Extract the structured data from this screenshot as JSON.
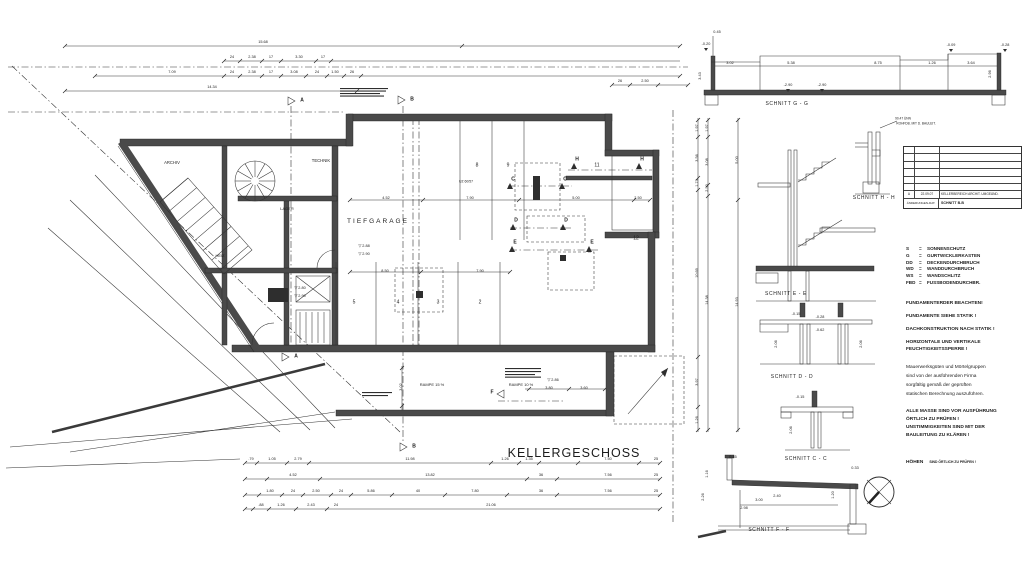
{
  "title": "KELLERGESCHOSS",
  "colors": {
    "ink": "#2a2a2a",
    "paper": "#ffffff"
  },
  "plan": {
    "text_labels": [
      {
        "t": "TIEFGARAGE",
        "x": 378,
        "y": 222,
        "s": 6.5,
        "ls": 2
      },
      {
        "t": "ARCHIV",
        "x": 172,
        "y": 163,
        "s": 4.2
      },
      {
        "t": "TECHNIK",
        "x": 321,
        "y": 161,
        "s": 4.2
      },
      {
        "t": "LAGER",
        "x": 287,
        "y": 209,
        "s": 4
      },
      {
        "t": "HEIZ",
        "x": 220,
        "y": 256,
        "s": 4
      },
      {
        "t": "8",
        "x": 477,
        "y": 166,
        "s": 5
      },
      {
        "t": "9",
        "x": 508,
        "y": 166,
        "s": 5
      },
      {
        "t": "11",
        "x": 597,
        "y": 166,
        "s": 5
      },
      {
        "t": "12",
        "x": 636,
        "y": 239,
        "s": 5
      },
      {
        "t": "5",
        "x": 354,
        "y": 303,
        "s": 5
      },
      {
        "t": "4",
        "x": 398,
        "y": 303,
        "s": 5
      },
      {
        "t": "3",
        "x": 438,
        "y": 303,
        "s": 5
      },
      {
        "t": "2",
        "x": 480,
        "y": 303,
        "s": 5
      },
      {
        "t": "RAMPE 15 %",
        "x": 432,
        "y": 385,
        "s": 4
      },
      {
        "t": "RAMPE 10 %",
        "x": 521,
        "y": 385,
        "s": 4
      },
      {
        "t": "▽ 2.88",
        "x": 364,
        "y": 247,
        "s": 3.8
      },
      {
        "t": "▽ 2.90",
        "x": 364,
        "y": 255,
        "s": 3.8
      },
      {
        "t": "▽ 2.80",
        "x": 300,
        "y": 289,
        "s": 3.8
      },
      {
        "t": "▽ 2.90",
        "x": 300,
        "y": 297,
        "s": 3.8
      },
      {
        "t": "▽ 2.86",
        "x": 553,
        "y": 381,
        "s": 3.8
      },
      {
        "t": "UZ 60/57",
        "x": 466,
        "y": 182,
        "s": 3.4
      }
    ],
    "section_markers": [
      {
        "t": "A",
        "x": 302,
        "y": 101
      },
      {
        "t": "B",
        "x": 412,
        "y": 100
      },
      {
        "t": "A",
        "x": 296,
        "y": 357
      },
      {
        "t": "B",
        "x": 414,
        "y": 447
      },
      {
        "t": "F",
        "x": 492,
        "y": 393
      },
      {
        "t": "H",
        "x": 577,
        "y": 160
      },
      {
        "t": "H",
        "x": 642,
        "y": 160
      },
      {
        "t": "C",
        "x": 513,
        "y": 180
      },
      {
        "t": "C",
        "x": 565,
        "y": 180
      },
      {
        "t": "D",
        "x": 516,
        "y": 221
      },
      {
        "t": "D",
        "x": 566,
        "y": 221
      },
      {
        "t": "E",
        "x": 515,
        "y": 243
      },
      {
        "t": "E",
        "x": 592,
        "y": 243
      }
    ],
    "dim_labels": [
      {
        "t": "15.68",
        "x": 263,
        "y": 43
      },
      {
        "t": "24",
        "x": 232,
        "y": 58
      },
      {
        "t": "2.38",
        "x": 252,
        "y": 58
      },
      {
        "t": "17",
        "x": 271,
        "y": 58
      },
      {
        "t": "3.30",
        "x": 299,
        "y": 58
      },
      {
        "t": "17",
        "x": 323,
        "y": 58
      },
      {
        "t": "7.09",
        "x": 172,
        "y": 73
      },
      {
        "t": "24",
        "x": 232,
        "y": 73
      },
      {
        "t": "2.38",
        "x": 252,
        "y": 73
      },
      {
        "t": "17",
        "x": 271,
        "y": 73
      },
      {
        "t": "3.08",
        "x": 294,
        "y": 73
      },
      {
        "t": "24",
        "x": 317,
        "y": 73
      },
      {
        "t": "1.50",
        "x": 335,
        "y": 73
      },
      {
        "t": "26",
        "x": 352,
        "y": 73
      },
      {
        "t": "14.34",
        "x": 212,
        "y": 88
      },
      {
        "t": "26",
        "x": 620,
        "y": 82
      },
      {
        "t": "2.50",
        "x": 645,
        "y": 82
      },
      {
        "t": ".79",
        "x": 251,
        "y": 460
      },
      {
        "t": "1.05",
        "x": 272,
        "y": 460
      },
      {
        "t": "2.79",
        "x": 298,
        "y": 460
      },
      {
        "t": "11.98",
        "x": 410,
        "y": 460
      },
      {
        "t": "1.26",
        "x": 505,
        "y": 460
      },
      {
        "t": "1.35",
        "x": 529,
        "y": 460
      },
      {
        "t": "7.50",
        "x": 608,
        "y": 460
      },
      {
        "t": "25",
        "x": 656,
        "y": 460
      },
      {
        "t": "4.52",
        "x": 293,
        "y": 476
      },
      {
        "t": "13.82",
        "x": 430,
        "y": 476
      },
      {
        "t": "36",
        "x": 541,
        "y": 476
      },
      {
        "t": "7.56",
        "x": 608,
        "y": 476
      },
      {
        "t": "25",
        "x": 656,
        "y": 476
      },
      {
        "t": "1.80",
        "x": 270,
        "y": 492
      },
      {
        "t": "24",
        "x": 293,
        "y": 492
      },
      {
        "t": "2.50",
        "x": 316,
        "y": 492
      },
      {
        "t": "24",
        "x": 341,
        "y": 492
      },
      {
        "t": "5.86",
        "x": 371,
        "y": 492
      },
      {
        "t": "40",
        "x": 418,
        "y": 492
      },
      {
        "t": "7.80",
        "x": 475,
        "y": 492
      },
      {
        "t": "36",
        "x": 541,
        "y": 492
      },
      {
        "t": "7.56",
        "x": 608,
        "y": 492
      },
      {
        "t": "25",
        "x": 656,
        "y": 492
      },
      {
        "t": ".88",
        "x": 261,
        "y": 506
      },
      {
        "t": "1.26",
        "x": 281,
        "y": 506
      },
      {
        "t": "2.43",
        "x": 311,
        "y": 506
      },
      {
        "t": "24",
        "x": 336,
        "y": 506
      },
      {
        "t": "21.06",
        "x": 491,
        "y": 506
      },
      {
        "t": "1.97",
        "x": 698,
        "y": 128,
        "r": 1
      },
      {
        "t": "3.56",
        "x": 698,
        "y": 158,
        "r": 1
      },
      {
        "t": "1.73",
        "x": 698,
        "y": 183,
        "r": 1
      },
      {
        "t": "10.69",
        "x": 698,
        "y": 273,
        "r": 1
      },
      {
        "t": "3.97",
        "x": 698,
        "y": 382,
        "r": 1
      },
      {
        "t": "1.26",
        "x": 698,
        "y": 420,
        "r": 1
      },
      {
        "t": "1.97",
        "x": 708,
        "y": 128,
        "r": 1
      },
      {
        "t": "3.08",
        "x": 708,
        "y": 162,
        "r": 1
      },
      {
        "t": "2.50",
        "x": 708,
        "y": 188,
        "r": 1
      },
      {
        "t": "14.38",
        "x": 708,
        "y": 300,
        "r": 1
      },
      {
        "t": "5.00",
        "x": 738,
        "y": 160,
        "r": 1
      },
      {
        "t": "14.93",
        "x": 738,
        "y": 302,
        "r": 1
      },
      {
        "t": "4.52",
        "x": 386,
        "y": 199
      },
      {
        "t": "7.90",
        "x": 470,
        "y": 199
      },
      {
        "t": "5.00",
        "x": 576,
        "y": 199
      },
      {
        "t": "2.50",
        "x": 638,
        "y": 199
      },
      {
        "t": "8.50",
        "x": 385,
        "y": 272
      },
      {
        "t": "7.90",
        "x": 480,
        "y": 272
      },
      {
        "t": "3.80",
        "x": 549,
        "y": 389
      },
      {
        "t": "3.60",
        "x": 584,
        "y": 389
      },
      {
        "t": "3.02",
        "x": 402,
        "y": 387,
        "r": 1
      },
      {
        "t": "0.45",
        "x": 717,
        "y": 33
      },
      {
        "t": "-0.20",
        "x": 706,
        "y": 45
      },
      {
        "t": "-0.09",
        "x": 951,
        "y": 46
      },
      {
        "t": "-0.28",
        "x": 1005,
        "y": 46
      },
      {
        "t": "3.02",
        "x": 730,
        "y": 64
      },
      {
        "t": "5.38",
        "x": 791,
        "y": 64
      },
      {
        "t": "8.75",
        "x": 878,
        "y": 64
      },
      {
        "t": "1.26",
        "x": 932,
        "y": 64
      },
      {
        "t": "3.64",
        "x": 971,
        "y": 64
      },
      {
        "t": "-2.90",
        "x": 788,
        "y": 86
      },
      {
        "t": "-2.90",
        "x": 822,
        "y": 86
      },
      {
        "t": "3.43",
        "x": 701,
        "y": 76,
        "r": 1
      },
      {
        "t": "2.96",
        "x": 991,
        "y": 74,
        "r": 1
      },
      {
        "t": "90.47 ÜNN",
        "x": 903,
        "y": 119,
        "s": 3.2
      },
      {
        "t": "ROHFDB. MIT D. BAULEIT.",
        "x": 916,
        "y": 124,
        "s": 3.2
      },
      {
        "t": "-0.15",
        "x": 796,
        "y": 315
      },
      {
        "t": "-0.28",
        "x": 820,
        "y": 318
      },
      {
        "t": "-0.62",
        "x": 820,
        "y": 331
      },
      {
        "t": "2.06",
        "x": 777,
        "y": 344,
        "r": 1
      },
      {
        "t": "2.06",
        "x": 862,
        "y": 344,
        "r": 1
      },
      {
        "t": "-0.15",
        "x": 800,
        "y": 398
      },
      {
        "t": "2.06",
        "x": 792,
        "y": 430,
        "r": 1
      },
      {
        "t": "0.45",
        "x": 733,
        "y": 458
      },
      {
        "t": "0.33",
        "x": 855,
        "y": 469
      },
      {
        "t": "2.40",
        "x": 777,
        "y": 497
      },
      {
        "t": "3.00",
        "x": 759,
        "y": 501
      },
      {
        "t": "1.20",
        "x": 834,
        "y": 495,
        "r": 1
      },
      {
        "t": "2.98",
        "x": 744,
        "y": 509
      },
      {
        "t": "2.26",
        "x": 704,
        "y": 497,
        "r": 1
      },
      {
        "t": "1.16",
        "x": 708,
        "y": 474,
        "r": 1
      }
    ]
  },
  "sections": {
    "g": {
      "label": "SCHNITT G - G"
    },
    "h": {
      "label": "SCHNITT H - H"
    },
    "e": {
      "label": "SCHNITT E - E"
    },
    "d": {
      "label": "SCHNITT D - D"
    },
    "c": {
      "label": "SCHNITT C - C"
    },
    "f": {
      "label": "SCHNITT F - F"
    }
  },
  "revision_table": {
    "rev": "A",
    "date": "22.09.07",
    "desc": "KELLERBEREICH ARCHIT. UMGEÄND.",
    "footer_left": "ÄNDERUNGEN-DAT.",
    "footer_right": "SCHNITT B-B"
  },
  "legend": {
    "items": [
      {
        "abbr": "S",
        "eq": "=",
        "name": "SONNENSCHUTZ"
      },
      {
        "abbr": "G",
        "eq": "=",
        "name": "GURTWICKLERKASTEN"
      },
      {
        "abbr": "DD",
        "eq": "=",
        "name": "DECKENDURCHBRUCH"
      },
      {
        "abbr": "WD",
        "eq": "=",
        "name": "WANDDURCHBRUCH"
      },
      {
        "abbr": "WS",
        "eq": "=",
        "name": "WANDSCHLITZ"
      },
      {
        "abbr": "FBD",
        "eq": "=",
        "name": "FUSSBODENDURCHBR."
      }
    ]
  },
  "notes_block1": [
    {
      "t": "FUNDAMENTERDER BEACHTEN!",
      "dy": 0
    },
    {
      "t": "FUNDAMENTE SIEHE STATIK !",
      "dy": 13
    },
    {
      "t": "DACHKONSTRUKTION NACH STATIK !",
      "dy": 13
    },
    {
      "t": "HORIZONTALE UND VERTIKALE",
      "dy": 13
    },
    {
      "t": "FEUCHTIGKEITSSPERRE !",
      "dy": 7
    }
  ],
  "paragraph": [
    {
      "t": "Mauerwerksgüten und Mörtelgruppen",
      "dy": 0
    },
    {
      "t": "sind von der ausführenden Firma",
      "dy": 9
    },
    {
      "t": "sorgfältig gemäß der geprüften",
      "dy": 9
    },
    {
      "t": "statischen Berechnung auszuführen.",
      "dy": 9
    }
  ],
  "notes_block2": [
    {
      "t": "ALLE MASSE SIND VOR AUSFÜHRUNG",
      "dy": 0
    },
    {
      "t": "ÖRTLICH ZU PRÜFEN !",
      "dy": 8
    },
    {
      "t": "UNSTIMMIGKEITEN SIND MIT DER",
      "dy": 8
    },
    {
      "t": "BAULEITUNG ZU KLÄREN !",
      "dy": 8
    }
  ],
  "hoehen": {
    "label": "HÖHEN",
    "rest": "SIND ÖRTLICH ZU PRÜFEN !"
  }
}
